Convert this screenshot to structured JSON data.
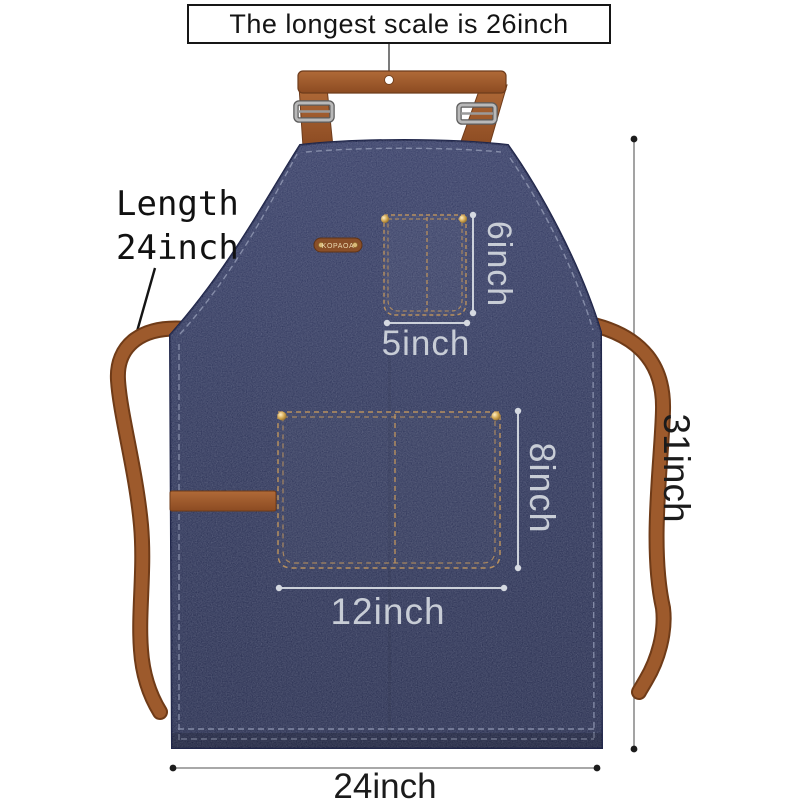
{
  "labels": {
    "top_note": "The longest scale is 26inch",
    "length_line1": "Length",
    "length_line2": "24inch",
    "chest_pocket_height": "6inch",
    "chest_pocket_width": "5inch",
    "waist_pocket_height": "8inch",
    "waist_pocket_width": "12inch",
    "overall_height": "31inch",
    "overall_width": "24inch",
    "brand": "KOPAOA"
  },
  "colors": {
    "background": "#ffffff",
    "denim": "#343b5f",
    "denim_edge": "#20264a",
    "leather_strap": "#9d5a2c",
    "stitching": "#b8905e",
    "dimension_light": "#ccd1da",
    "dimension_dark": "#8c8c8c",
    "label_text": "#1b1b1b"
  }
}
